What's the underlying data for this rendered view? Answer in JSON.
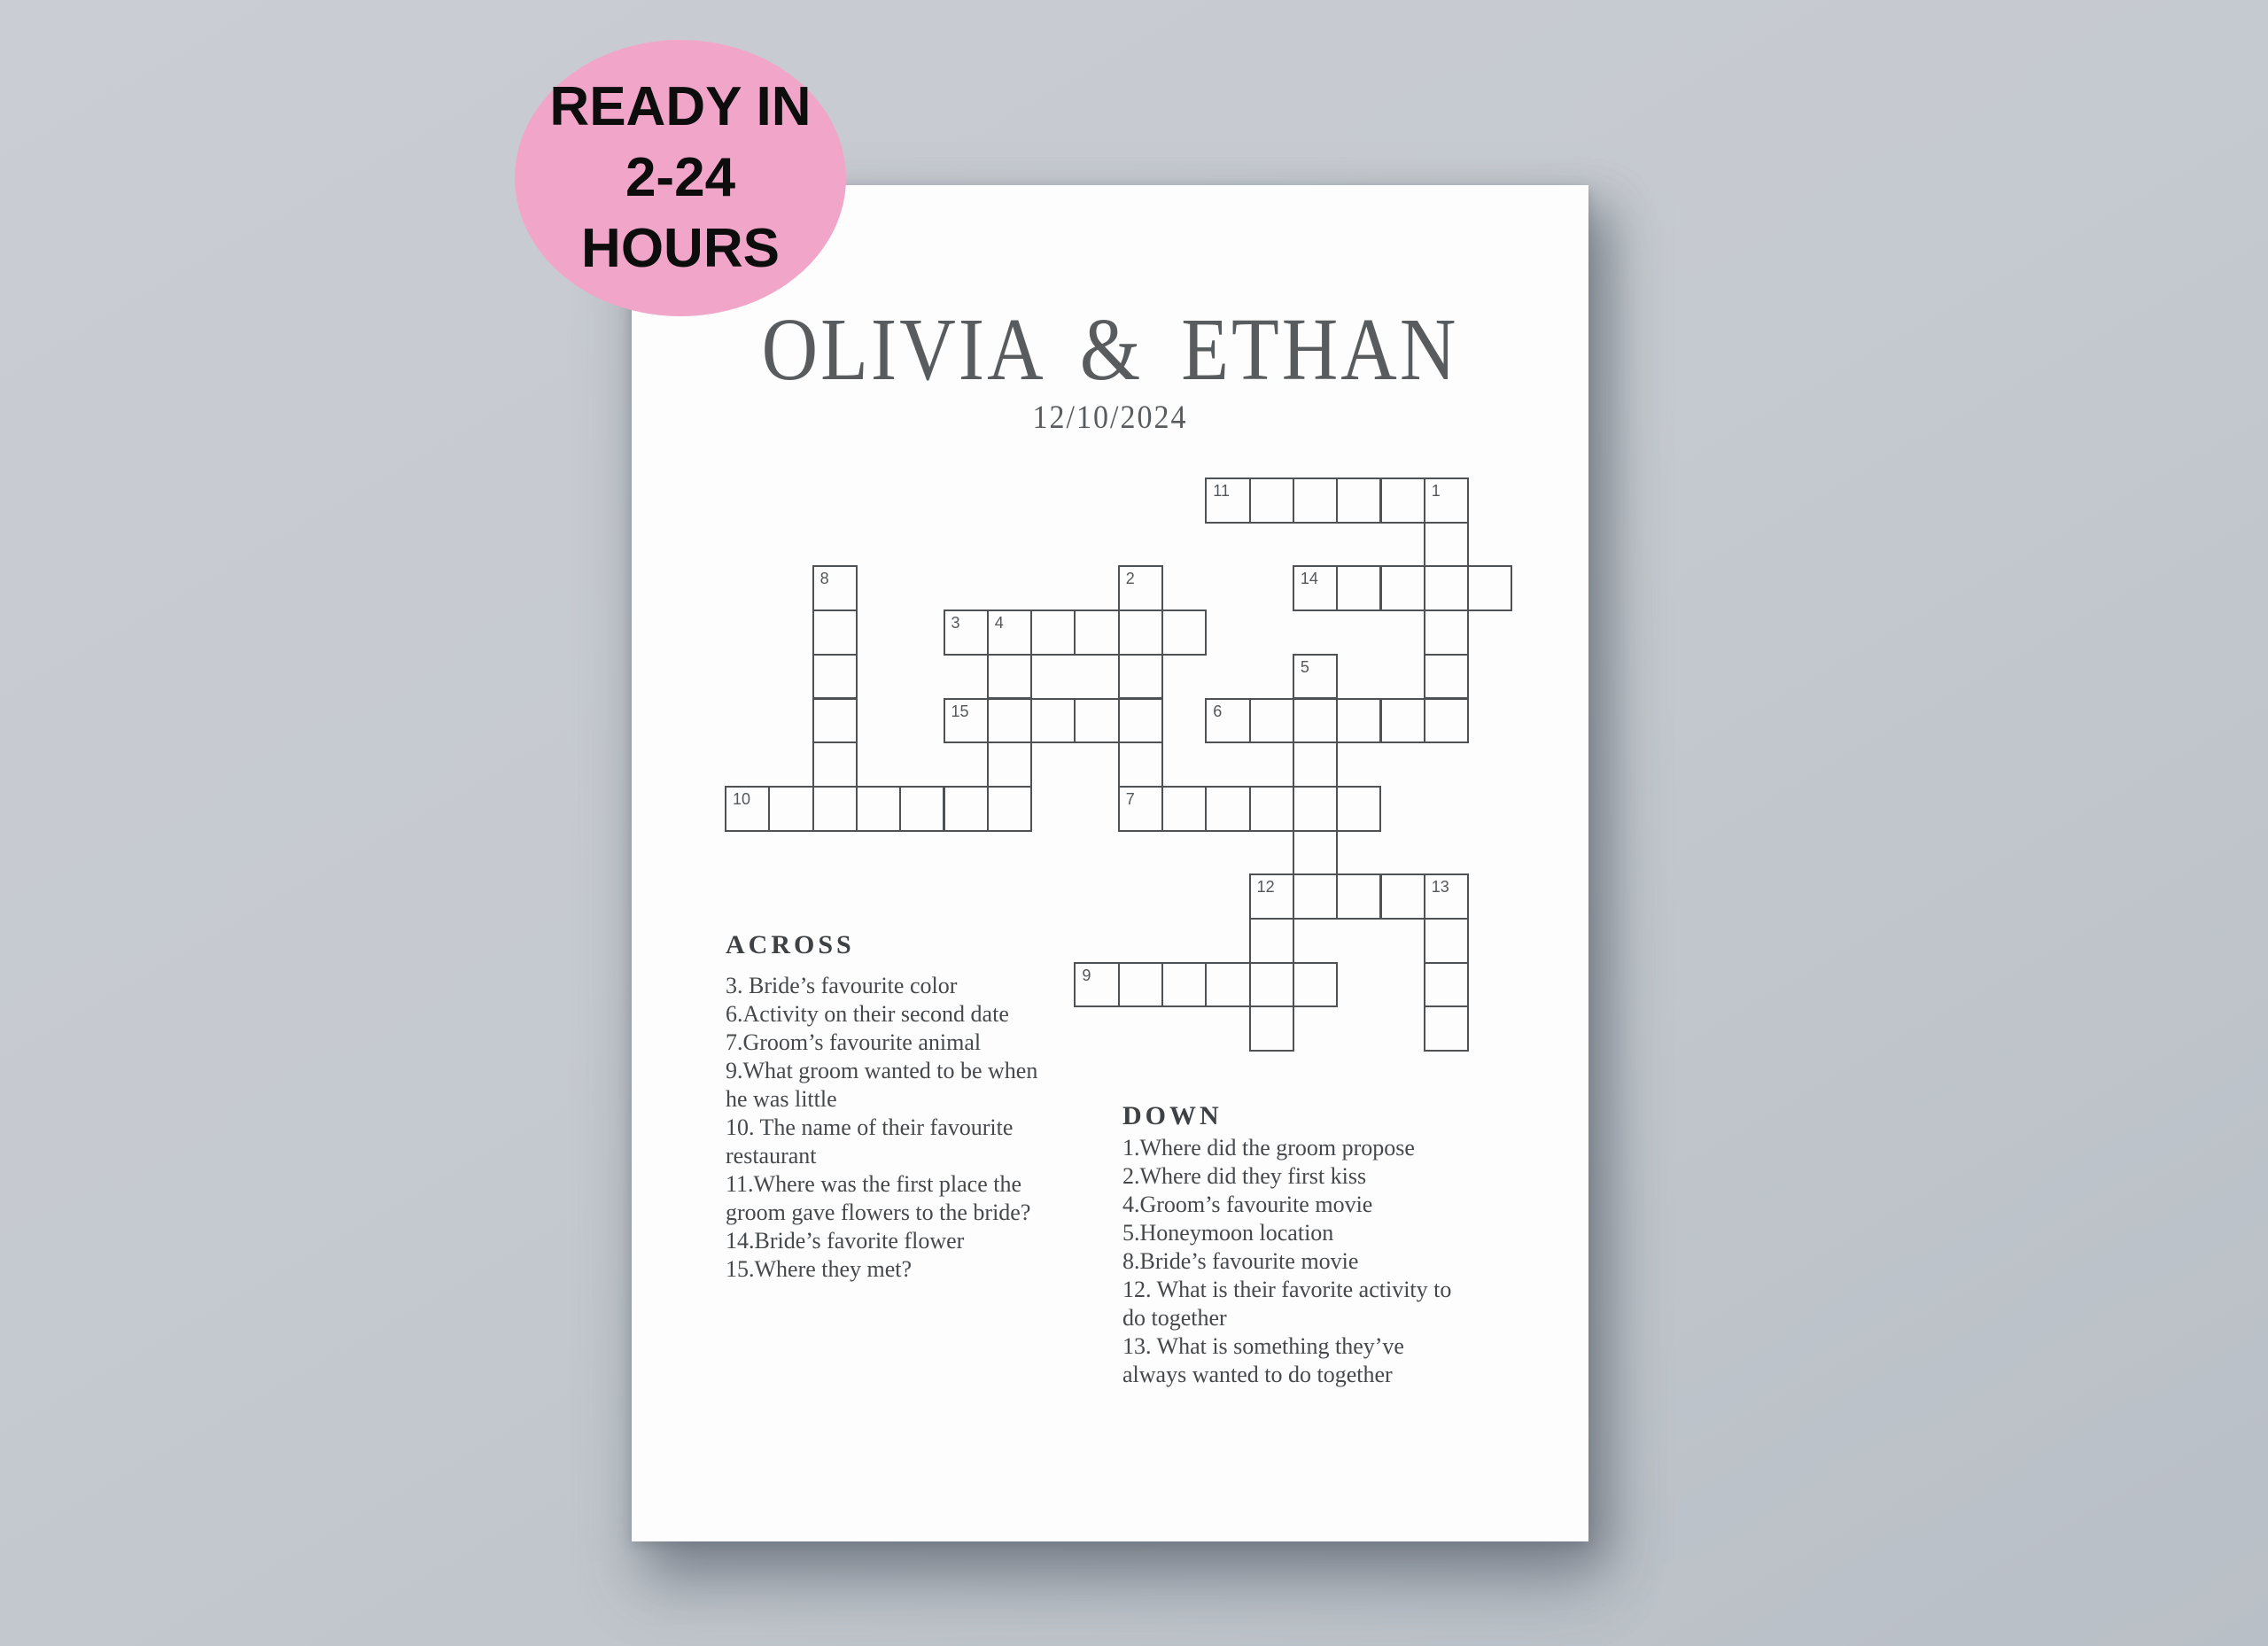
{
  "badge": {
    "lines": [
      "READY IN",
      "2-24",
      "HOURS"
    ],
    "background": "#f1a6c9",
    "text_color": "#0d0d0d"
  },
  "poster": {
    "title": "OLIVIA & ETHAN",
    "date": "12/10/2024"
  },
  "crossword": {
    "cells": [
      {
        "c": 11,
        "r": 0,
        "n": "11"
      },
      {
        "c": 12,
        "r": 0
      },
      {
        "c": 13,
        "r": 0
      },
      {
        "c": 14,
        "r": 0
      },
      {
        "c": 15,
        "r": 0
      },
      {
        "c": 16,
        "r": 0,
        "n": "1"
      },
      {
        "c": 16,
        "r": 1
      },
      {
        "c": 2,
        "r": 2,
        "n": "8"
      },
      {
        "c": 9,
        "r": 2,
        "n": "2"
      },
      {
        "c": 13,
        "r": 2,
        "n": "14"
      },
      {
        "c": 14,
        "r": 2
      },
      {
        "c": 15,
        "r": 2
      },
      {
        "c": 16,
        "r": 2
      },
      {
        "c": 17,
        "r": 2
      },
      {
        "c": 2,
        "r": 3
      },
      {
        "c": 5,
        "r": 3,
        "n": "3"
      },
      {
        "c": 6,
        "r": 3,
        "n": "4"
      },
      {
        "c": 7,
        "r": 3
      },
      {
        "c": 8,
        "r": 3
      },
      {
        "c": 9,
        "r": 3
      },
      {
        "c": 10,
        "r": 3
      },
      {
        "c": 16,
        "r": 3
      },
      {
        "c": 2,
        "r": 4
      },
      {
        "c": 6,
        "r": 4
      },
      {
        "c": 9,
        "r": 4
      },
      {
        "c": 13,
        "r": 4,
        "n": "5"
      },
      {
        "c": 16,
        "r": 4
      },
      {
        "c": 2,
        "r": 5
      },
      {
        "c": 5,
        "r": 5,
        "n": "15"
      },
      {
        "c": 6,
        "r": 5
      },
      {
        "c": 7,
        "r": 5
      },
      {
        "c": 8,
        "r": 5
      },
      {
        "c": 9,
        "r": 5
      },
      {
        "c": 11,
        "r": 5,
        "n": "6"
      },
      {
        "c": 12,
        "r": 5
      },
      {
        "c": 13,
        "r": 5
      },
      {
        "c": 14,
        "r": 5
      },
      {
        "c": 15,
        "r": 5
      },
      {
        "c": 16,
        "r": 5
      },
      {
        "c": 2,
        "r": 6
      },
      {
        "c": 6,
        "r": 6
      },
      {
        "c": 9,
        "r": 6
      },
      {
        "c": 13,
        "r": 6
      },
      {
        "c": 0,
        "r": 7,
        "n": "10"
      },
      {
        "c": 1,
        "r": 7
      },
      {
        "c": 2,
        "r": 7
      },
      {
        "c": 3,
        "r": 7
      },
      {
        "c": 4,
        "r": 7
      },
      {
        "c": 5,
        "r": 7
      },
      {
        "c": 6,
        "r": 7
      },
      {
        "c": 9,
        "r": 7,
        "n": "7"
      },
      {
        "c": 10,
        "r": 7
      },
      {
        "c": 11,
        "r": 7
      },
      {
        "c": 12,
        "r": 7
      },
      {
        "c": 13,
        "r": 7
      },
      {
        "c": 14,
        "r": 7
      },
      {
        "c": 13,
        "r": 8
      },
      {
        "c": 12,
        "r": 9,
        "n": "12"
      },
      {
        "c": 13,
        "r": 9
      },
      {
        "c": 14,
        "r": 9
      },
      {
        "c": 15,
        "r": 9
      },
      {
        "c": 16,
        "r": 9,
        "n": "13"
      },
      {
        "c": 12,
        "r": 10
      },
      {
        "c": 16,
        "r": 10
      },
      {
        "c": 8,
        "r": 11,
        "n": "9"
      },
      {
        "c": 9,
        "r": 11
      },
      {
        "c": 10,
        "r": 11
      },
      {
        "c": 11,
        "r": 11
      },
      {
        "c": 12,
        "r": 11
      },
      {
        "c": 13,
        "r": 11
      },
      {
        "c": 16,
        "r": 11
      },
      {
        "c": 12,
        "r": 12
      },
      {
        "c": 16,
        "r": 12
      }
    ]
  },
  "across": {
    "heading": "ACROSS",
    "clues": [
      "3. Bride’s favourite color",
      "6.Activity on their second date",
      "7.Groom’s favourite animal",
      "9.What groom wanted to be when\nhe was little",
      "10. The name of their favourite\nrestaurant",
      "11.Where was the first place the\ngroom gave flowers to the bride?",
      "14.Bride’s favorite flower",
      "15.Where they met?"
    ]
  },
  "down": {
    "heading": "DOWN",
    "clues": [
      "1.Where did the groom propose",
      "2.Where did they first kiss",
      "4.Groom’s favourite movie",
      "5.Honeymoon location",
      "8.Bride’s favourite movie",
      "12. What is their favorite activity to\ndo together",
      "13. What is something they’ve\nalways wanted to do together"
    ]
  },
  "colors": {
    "background_top": "#cacdd3",
    "background_bottom": "#b9bfc6",
    "grid_line": "#4f5254",
    "title": "#585c5e",
    "heading": "#3d4144",
    "clue_text": "#45494c",
    "number": "#54575a"
  }
}
